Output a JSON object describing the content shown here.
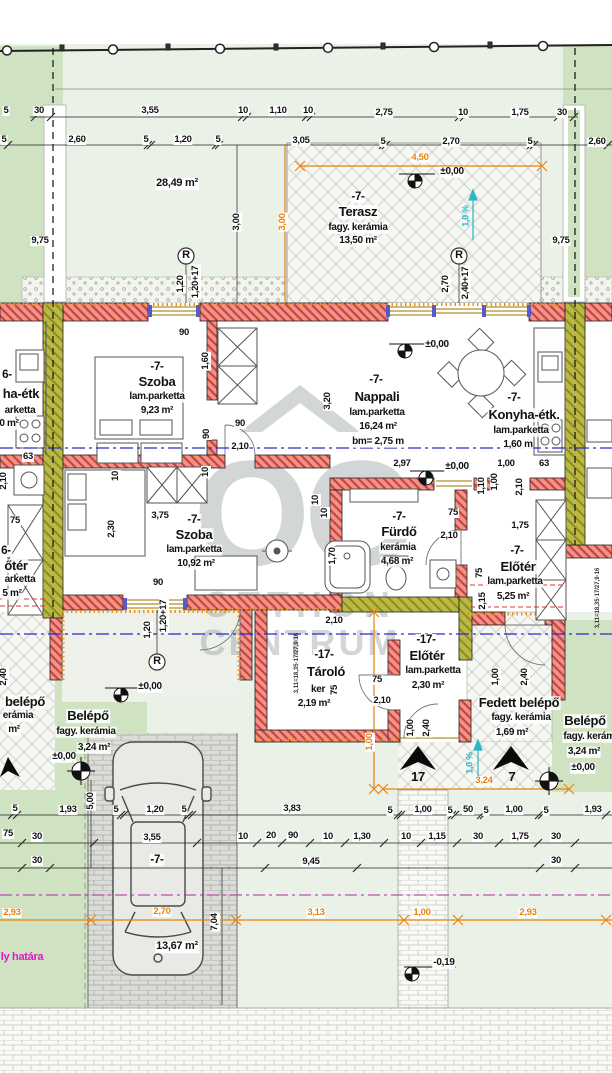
{
  "drawing": {
    "type": "architectural-floor-plan",
    "language": "hu"
  },
  "watermark": {
    "monogram": "OC",
    "line1": "OTTHON",
    "line2": "CENTRUM"
  },
  "colors": {
    "wall": "#f2928a",
    "wall_hatch": "#c5463c",
    "party_wall": "#b9b944",
    "insulation": "#ea9120",
    "dim_orange": "#e8820a",
    "slope_cyan": "#2ab6c6",
    "boundary_magenta": "#e018c8",
    "section_blue": "#2a2ac8",
    "lawn": "#cfe3c2",
    "lawn_pale": "#eaf1e6"
  },
  "labels": [
    {
      "t": "5",
      "x": 6,
      "y": 111,
      "cls": "dim"
    },
    {
      "t": "30",
      "x": 39,
      "y": 111,
      "cls": "dim"
    },
    {
      "t": "3,55",
      "x": 150,
      "y": 111,
      "cls": "dim"
    },
    {
      "t": "10",
      "x": 243,
      "y": 111,
      "cls": "dim"
    },
    {
      "t": "1,10",
      "x": 278,
      "y": 111,
      "cls": "dim"
    },
    {
      "t": "10",
      "x": 308,
      "y": 111,
      "cls": "dim"
    },
    {
      "t": "2,75",
      "x": 384,
      "y": 113,
      "cls": "dim"
    },
    {
      "t": "10",
      "x": 463,
      "y": 113,
      "cls": "dim"
    },
    {
      "t": "1,75",
      "x": 520,
      "y": 113,
      "cls": "dim"
    },
    {
      "t": "30",
      "x": 562,
      "y": 113,
      "cls": "dim"
    },
    {
      "t": "5",
      "x": 4,
      "y": 140,
      "cls": "dim"
    },
    {
      "t": "2,60",
      "x": 77,
      "y": 140,
      "cls": "dim"
    },
    {
      "t": "5",
      "x": 146,
      "y": 140,
      "cls": "dim"
    },
    {
      "t": "1,20",
      "x": 183,
      "y": 140,
      "cls": "dim"
    },
    {
      "t": "5",
      "x": 218,
      "y": 140,
      "cls": "dim"
    },
    {
      "t": "3,05",
      "x": 301,
      "y": 141,
      "cls": "dim"
    },
    {
      "t": "5",
      "x": 383,
      "y": 142,
      "cls": "dim"
    },
    {
      "t": "2,70",
      "x": 451,
      "y": 142,
      "cls": "dim"
    },
    {
      "t": "5",
      "x": 530,
      "y": 142,
      "cls": "dim"
    },
    {
      "t": "2,60",
      "x": 597,
      "y": 142,
      "cls": "dim"
    },
    {
      "t": "9,75",
      "x": 40,
      "y": 241,
      "cls": "dim"
    },
    {
      "t": "9,75",
      "x": 561,
      "y": 241,
      "cls": "dim"
    },
    {
      "t": "3,00",
      "x": 237,
      "y": 222,
      "cls": "dim",
      "rot": true
    },
    {
      "t": "3,00",
      "x": 283,
      "y": 222,
      "cls": "dim orange",
      "rot": true
    },
    {
      "t": "4,50",
      "x": 420,
      "y": 158,
      "cls": "dim orange"
    },
    {
      "t": "±0,00",
      "x": 452,
      "y": 172,
      "cls": "lvl"
    },
    {
      "t": "-7-",
      "x": 358,
      "y": 197,
      "cls": "unit"
    },
    {
      "t": "Terasz",
      "x": 358,
      "y": 212,
      "cls": "room"
    },
    {
      "t": "fagy. kerámia",
      "x": 358,
      "y": 228,
      "cls": "sub"
    },
    {
      "t": "13,50 m²",
      "x": 358,
      "y": 241,
      "cls": "sub"
    },
    {
      "t": "28,49 m²",
      "x": 177,
      "y": 184,
      "cls": "area"
    },
    {
      "t": "1,0 %",
      "x": 466,
      "y": 216,
      "cls": "cyan",
      "rot": true
    },
    {
      "t": "R",
      "x": 186,
      "y": 256,
      "cls": "rsym"
    },
    {
      "t": "R",
      "x": 459,
      "y": 256,
      "cls": "rsym"
    },
    {
      "t": "1,20",
      "x": 181,
      "y": 284,
      "cls": "dim",
      "rot": true
    },
    {
      "t": "1,20+17",
      "x": 196,
      "y": 282,
      "cls": "dim",
      "rot": true
    },
    {
      "t": "2,70",
      "x": 446,
      "y": 284,
      "cls": "dim",
      "rot": true
    },
    {
      "t": "2,40+17",
      "x": 466,
      "y": 283,
      "cls": "dim",
      "rot": true
    },
    {
      "t": "90",
      "x": 184,
      "y": 333,
      "cls": "dim"
    },
    {
      "t": "1,60",
      "x": 206,
      "y": 361,
      "cls": "dim",
      "rot": true
    },
    {
      "t": "-7-",
      "x": 157,
      "y": 367,
      "cls": "unit"
    },
    {
      "t": "Szoba",
      "x": 157,
      "y": 382,
      "cls": "room"
    },
    {
      "t": "lam.parketta",
      "x": 157,
      "y": 397,
      "cls": "sub"
    },
    {
      "t": "9,23 m²",
      "x": 157,
      "y": 411,
      "cls": "sub"
    },
    {
      "t": "-7-",
      "x": 376,
      "y": 380,
      "cls": "unit"
    },
    {
      "t": "Nappali",
      "x": 377,
      "y": 397,
      "cls": "room"
    },
    {
      "t": "lam.parketta",
      "x": 377,
      "y": 413,
      "cls": "sub"
    },
    {
      "t": "16,24 m²",
      "x": 378,
      "y": 427,
      "cls": "sub"
    },
    {
      "t": "bm= 2,75 m",
      "x": 378,
      "y": 442,
      "cls": "sub"
    },
    {
      "t": "±0,00",
      "x": 437,
      "y": 345,
      "cls": "lvl"
    },
    {
      "t": "3,20",
      "x": 328,
      "y": 401,
      "cls": "dim",
      "rot": true
    },
    {
      "t": "-7-",
      "x": 514,
      "y": 398,
      "cls": "unit"
    },
    {
      "t": "Konyha-étk.",
      "x": 524,
      "y": 415,
      "cls": "room"
    },
    {
      "t": "lam.parketta",
      "x": 521,
      "y": 431,
      "cls": "sub"
    },
    {
      "t": "1,60 m",
      "x": 518,
      "y": 445,
      "cls": "sub"
    },
    {
      "t": "90",
      "x": 240,
      "y": 424,
      "cls": "dim"
    },
    {
      "t": "90",
      "x": 207,
      "y": 434,
      "cls": "dim",
      "rot": true
    },
    {
      "t": "2,10",
      "x": 240,
      "y": 447,
      "cls": "dim"
    },
    {
      "t": "63",
      "x": 28,
      "y": 457,
      "cls": "dim"
    },
    {
      "t": "2,10",
      "x": 4,
      "y": 481,
      "cls": "dim",
      "rot": true
    },
    {
      "t": "2,97",
      "x": 402,
      "y": 464,
      "cls": "dim"
    },
    {
      "t": "±0,00",
      "x": 457,
      "y": 467,
      "cls": "lvl"
    },
    {
      "t": "1,00",
      "x": 506,
      "y": 464,
      "cls": "dim"
    },
    {
      "t": "63",
      "x": 544,
      "y": 464,
      "cls": "dim"
    },
    {
      "t": "1,00",
      "x": 495,
      "y": 482,
      "cls": "dim",
      "rot": true
    },
    {
      "t": "2,10",
      "x": 520,
      "y": 487,
      "cls": "dim",
      "rot": true
    },
    {
      "t": "1,10",
      "x": 482,
      "y": 486,
      "cls": "dim",
      "rot": true
    },
    {
      "t": "10",
      "x": 316,
      "y": 500,
      "cls": "dim",
      "rot": true
    },
    {
      "t": "10",
      "x": 116,
      "y": 476,
      "cls": "dim",
      "rot": true
    },
    {
      "t": "10",
      "x": 206,
      "y": 472,
      "cls": "dim",
      "rot": true
    },
    {
      "t": "75",
      "x": 15,
      "y": 521,
      "cls": "dim"
    },
    {
      "t": "3,75",
      "x": 160,
      "y": 516,
      "cls": "dim"
    },
    {
      "t": "2,30",
      "x": 112,
      "y": 529,
      "cls": "dim",
      "rot": true
    },
    {
      "t": "-7-",
      "x": 194,
      "y": 520,
      "cls": "unit"
    },
    {
      "t": "Szoba",
      "x": 194,
      "y": 535,
      "cls": "room"
    },
    {
      "t": "lam.parketta",
      "x": 194,
      "y": 550,
      "cls": "sub"
    },
    {
      "t": "10,92 m²",
      "x": 196,
      "y": 564,
      "cls": "sub"
    },
    {
      "t": "90",
      "x": 158,
      "y": 583,
      "cls": "dim"
    },
    {
      "t": "-7-",
      "x": 399,
      "y": 517,
      "cls": "unit"
    },
    {
      "t": "Fürdő",
      "x": 399,
      "y": 532,
      "cls": "room"
    },
    {
      "t": "kerámia",
      "x": 398,
      "y": 548,
      "cls": "sub"
    },
    {
      "t": "4,68 m²",
      "x": 397,
      "y": 562,
      "cls": "sub"
    },
    {
      "t": "75",
      "x": 453,
      "y": 513,
      "cls": "dim"
    },
    {
      "t": "2,10",
      "x": 449,
      "y": 536,
      "cls": "dim"
    },
    {
      "t": "10",
      "x": 325,
      "y": 513,
      "cls": "dim",
      "rot": true
    },
    {
      "t": "1,70",
      "x": 333,
      "y": 556,
      "cls": "dim",
      "rot": true
    },
    {
      "t": "-7-",
      "x": 517,
      "y": 551,
      "cls": "unit"
    },
    {
      "t": "Előtér",
      "x": 518,
      "y": 567,
      "cls": "room"
    },
    {
      "t": "lam.parketta",
      "x": 515,
      "y": 582,
      "cls": "sub"
    },
    {
      "t": "5,25 m²",
      "x": 513,
      "y": 597,
      "cls": "sub"
    },
    {
      "t": "1,75",
      "x": 520,
      "y": 526,
      "cls": "dim"
    },
    {
      "t": "75",
      "x": 480,
      "y": 573,
      "cls": "dim",
      "rot": true
    },
    {
      "t": "2,15",
      "x": 483,
      "y": 601,
      "cls": "dim",
      "rot": true
    },
    {
      "t": "3,11=18,35·17/27,9·16",
      "x": 598,
      "y": 598,
      "cls": "tiny",
      "rot": true
    },
    {
      "t": "3,11=18,35·17/27,9·16",
      "x": 297,
      "y": 663,
      "cls": "tiny",
      "rot": true
    },
    {
      "t": "6-",
      "x": 7,
      "y": 375,
      "cls": "unit"
    },
    {
      "t": "ha-étk",
      "x": 21,
      "y": 394,
      "cls": "room"
    },
    {
      "t": "arketta",
      "x": 20,
      "y": 411,
      "cls": "sub"
    },
    {
      "t": "0 m²",
      "x": 9,
      "y": 424,
      "cls": "sub"
    },
    {
      "t": "6-",
      "x": 6,
      "y": 551,
      "cls": "unit"
    },
    {
      "t": "őtér",
      "x": 16,
      "y": 566,
      "cls": "room"
    },
    {
      "t": "arketta",
      "x": 20,
      "y": 580,
      "cls": "sub"
    },
    {
      "t": "5 m²",
      "x": 12,
      "y": 594,
      "cls": "sub"
    },
    {
      "t": "1,20",
      "x": 148,
      "y": 630,
      "cls": "dim",
      "rot": true
    },
    {
      "t": "1,20+17",
      "x": 164,
      "y": 616,
      "cls": "dim",
      "rot": true
    },
    {
      "t": "R",
      "x": 157,
      "y": 662,
      "cls": "rsym"
    },
    {
      "t": "±0,00",
      "x": 150,
      "y": 687,
      "cls": "lvl"
    },
    {
      "t": "2,40",
      "x": 4,
      "y": 677,
      "cls": "dim",
      "rot": true
    },
    {
      "t": "2,10",
      "x": 334,
      "y": 621,
      "cls": "dim"
    },
    {
      "t": "-17-",
      "x": 324,
      "y": 655,
      "cls": "unit"
    },
    {
      "t": "Tároló",
      "x": 326,
      "y": 672,
      "cls": "room"
    },
    {
      "t": "ker",
      "x": 318,
      "y": 690,
      "cls": "sub"
    },
    {
      "t": "2,19 m²",
      "x": 314,
      "y": 704,
      "cls": "sub"
    },
    {
      "t": "75",
      "x": 377,
      "y": 680,
      "cls": "dim"
    },
    {
      "t": "75",
      "x": 335,
      "y": 690,
      "cls": "dim",
      "rot": true
    },
    {
      "t": "2,10",
      "x": 382,
      "y": 701,
      "cls": "dim"
    },
    {
      "t": "-17-",
      "x": 426,
      "y": 640,
      "cls": "unit"
    },
    {
      "t": "Előtér",
      "x": 427,
      "y": 656,
      "cls": "room"
    },
    {
      "t": "lam.parketta",
      "x": 433,
      "y": 671,
      "cls": "sub"
    },
    {
      "t": "2,30 m²",
      "x": 428,
      "y": 686,
      "cls": "sub"
    },
    {
      "t": "1,00",
      "x": 411,
      "y": 728,
      "cls": "dim",
      "rot": true
    },
    {
      "t": "2,40",
      "x": 427,
      "y": 728,
      "cls": "dim",
      "rot": true
    },
    {
      "t": "Fedett belépő",
      "x": 519,
      "y": 703,
      "cls": "room"
    },
    {
      "t": "fagy. kerámia",
      "x": 521,
      "y": 718,
      "cls": "sub"
    },
    {
      "t": "1,69 m²",
      "x": 512,
      "y": 733,
      "cls": "sub"
    },
    {
      "t": "1,00",
      "x": 496,
      "y": 677,
      "cls": "dim",
      "rot": true
    },
    {
      "t": "2,40",
      "x": 525,
      "y": 677,
      "cls": "dim",
      "rot": true
    },
    {
      "t": "Belépő",
      "x": 585,
      "y": 721,
      "cls": "room"
    },
    {
      "t": "fagy. kerámia",
      "x": 593,
      "y": 737,
      "cls": "sub"
    },
    {
      "t": "3,24 m²",
      "x": 584,
      "y": 752,
      "cls": "sub"
    },
    {
      "t": "±0,00",
      "x": 583,
      "y": 768,
      "cls": "lvl"
    },
    {
      "t": "Belépő",
      "x": 88,
      "y": 716,
      "cls": "room"
    },
    {
      "t": "fagy. kerámia",
      "x": 86,
      "y": 732,
      "cls": "sub"
    },
    {
      "t": "3,24 m²",
      "x": 94,
      "y": 748,
      "cls": "sub"
    },
    {
      "t": "±0,00",
      "x": 64,
      "y": 757,
      "cls": "lvl"
    },
    {
      "t": "belépő",
      "x": 25,
      "y": 702,
      "cls": "room"
    },
    {
      "t": "erámia",
      "x": 18,
      "y": 716,
      "cls": "sub"
    },
    {
      "t": "m²",
      "x": 14,
      "y": 730,
      "cls": "sub"
    },
    {
      "t": "17",
      "x": 418,
      "y": 777,
      "cls": "arrw"
    },
    {
      "t": "7",
      "x": 512,
      "y": 777,
      "cls": "arrw"
    },
    {
      "t": "1,00",
      "x": 370,
      "y": 742,
      "cls": "dim orange",
      "rot": true
    },
    {
      "t": "3,24",
      "x": 484,
      "y": 781,
      "cls": "dim orange"
    },
    {
      "t": "1,0 %",
      "x": 470,
      "y": 763,
      "cls": "cyan",
      "rot": true
    },
    {
      "t": "5",
      "x": 15,
      "y": 809,
      "cls": "dim"
    },
    {
      "t": "1,93",
      "x": 68,
      "y": 810,
      "cls": "dim"
    },
    {
      "t": "5,00",
      "x": 91,
      "y": 801,
      "cls": "dim",
      "rot": true
    },
    {
      "t": "5",
      "x": 116,
      "y": 810,
      "cls": "dim"
    },
    {
      "t": "1,20",
      "x": 155,
      "y": 810,
      "cls": "dim"
    },
    {
      "t": "5",
      "x": 184,
      "y": 810,
      "cls": "dim"
    },
    {
      "t": "3,83",
      "x": 292,
      "y": 809,
      "cls": "dim"
    },
    {
      "t": "5",
      "x": 390,
      "y": 811,
      "cls": "dim"
    },
    {
      "t": "1,00",
      "x": 423,
      "y": 810,
      "cls": "dim"
    },
    {
      "t": "5",
      "x": 450,
      "y": 811,
      "cls": "dim"
    },
    {
      "t": "50",
      "x": 468,
      "y": 810,
      "cls": "dim"
    },
    {
      "t": "5",
      "x": 486,
      "y": 811,
      "cls": "dim"
    },
    {
      "t": "1,00",
      "x": 514,
      "y": 810,
      "cls": "dim"
    },
    {
      "t": "5",
      "x": 546,
      "y": 811,
      "cls": "dim"
    },
    {
      "t": "1,93",
      "x": 593,
      "y": 810,
      "cls": "dim"
    },
    {
      "t": "75",
      "x": 8,
      "y": 834,
      "cls": "dim"
    },
    {
      "t": "30",
      "x": 37,
      "y": 837,
      "cls": "dim"
    },
    {
      "t": "3,55",
      "x": 152,
      "y": 838,
      "cls": "dim"
    },
    {
      "t": "10",
      "x": 243,
      "y": 837,
      "cls": "dim"
    },
    {
      "t": "20",
      "x": 271,
      "y": 836,
      "cls": "dim"
    },
    {
      "t": "90",
      "x": 293,
      "y": 836,
      "cls": "dim"
    },
    {
      "t": "10",
      "x": 328,
      "y": 837,
      "cls": "dim"
    },
    {
      "t": "1,30",
      "x": 362,
      "y": 837,
      "cls": "dim"
    },
    {
      "t": "10",
      "x": 406,
      "y": 837,
      "cls": "dim"
    },
    {
      "t": "1,15",
      "x": 437,
      "y": 837,
      "cls": "dim"
    },
    {
      "t": "30",
      "x": 478,
      "y": 837,
      "cls": "dim"
    },
    {
      "t": "1,75",
      "x": 520,
      "y": 837,
      "cls": "dim"
    },
    {
      "t": "30",
      "x": 556,
      "y": 837,
      "cls": "dim"
    },
    {
      "t": "30",
      "x": 37,
      "y": 861,
      "cls": "dim"
    },
    {
      "t": "-7-",
      "x": 157,
      "y": 860,
      "cls": "unit"
    },
    {
      "t": "9,45",
      "x": 311,
      "y": 862,
      "cls": "dim"
    },
    {
      "t": "30",
      "x": 556,
      "y": 861,
      "cls": "dim"
    },
    {
      "t": "2,93",
      "x": 12,
      "y": 913,
      "cls": "dim orange"
    },
    {
      "t": "2,70",
      "x": 162,
      "y": 912,
      "cls": "dim orange"
    },
    {
      "t": "3,13",
      "x": 316,
      "y": 913,
      "cls": "dim orange"
    },
    {
      "t": "1,00",
      "x": 422,
      "y": 913,
      "cls": "dim orange"
    },
    {
      "t": "2,93",
      "x": 528,
      "y": 913,
      "cls": "dim orange"
    },
    {
      "t": "7,04",
      "x": 215,
      "y": 922,
      "cls": "dim",
      "rot": true
    },
    {
      "t": "13,67 m²",
      "x": 177,
      "y": 947,
      "cls": "area"
    },
    {
      "t": "ly határa",
      "x": 22,
      "y": 958,
      "cls": "mag"
    },
    {
      "t": "-0,19",
      "x": 444,
      "y": 963,
      "cls": "lvl"
    }
  ]
}
